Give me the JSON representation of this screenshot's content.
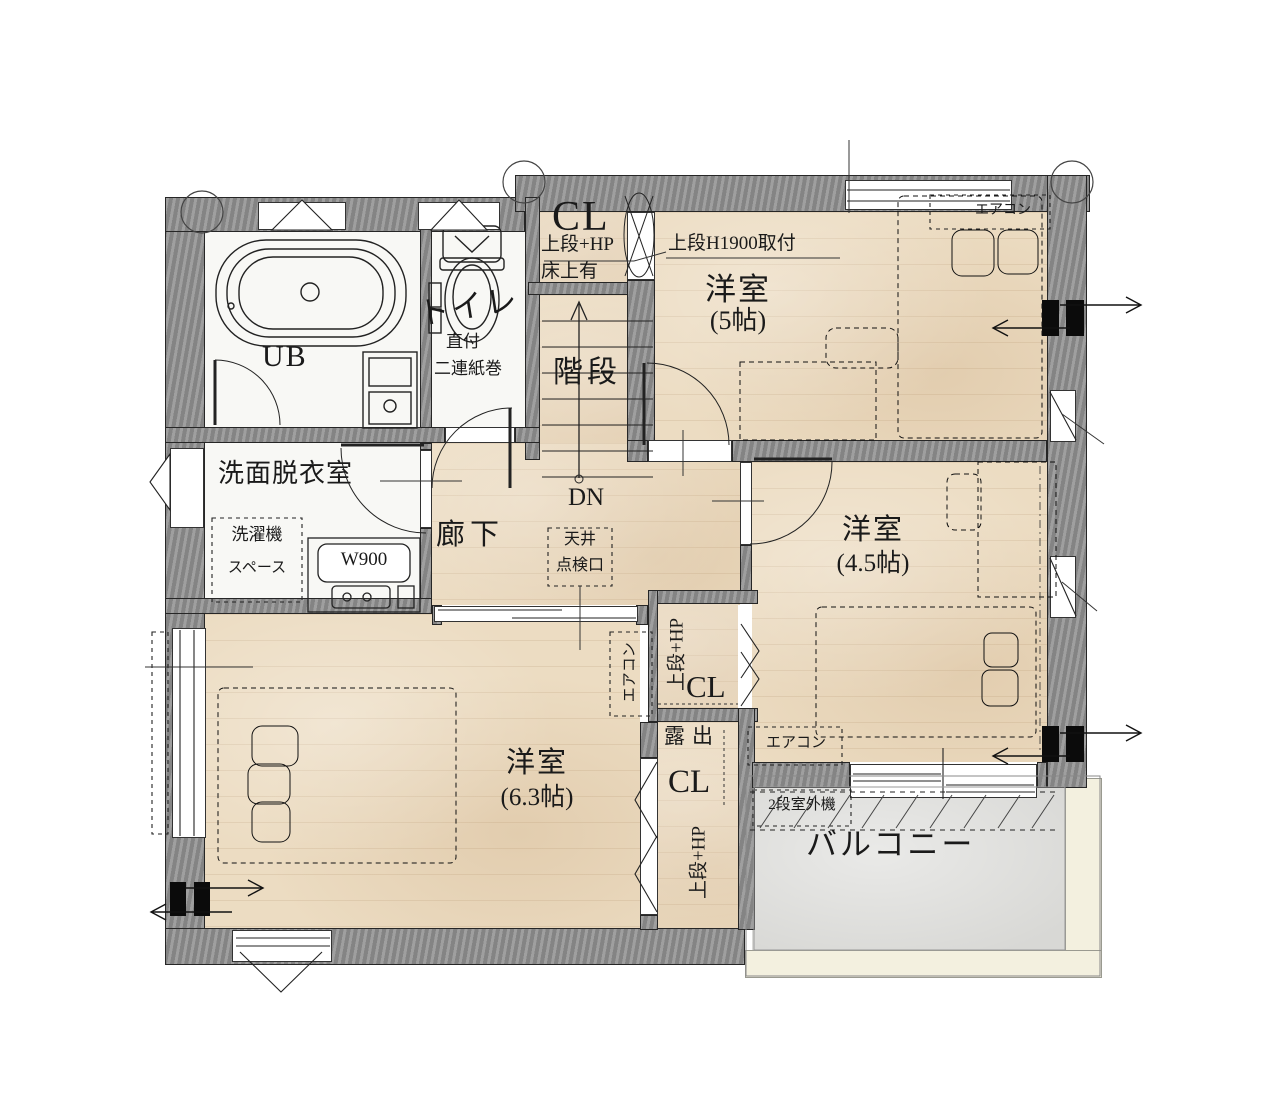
{
  "colors": {
    "floor_wood": "#ecdcc2",
    "floor_service": "#f8f8f5",
    "floor_balcony": "#d8d8d5",
    "wall": "#8f8f8f",
    "line": "#222222"
  },
  "labels": {
    "ub": "UB",
    "toilet": {
      "title": "トイレ",
      "note1": "直付",
      "note2": "二連紙巻"
    },
    "cl_top": {
      "title": "CL",
      "note1": "上段+HP",
      "note2": "床上有"
    },
    "stairs": {
      "title": "階段",
      "direction": "DN"
    },
    "room5": {
      "title": "洋室",
      "size": "(5帖)",
      "shelf_note": "上段H1900取付",
      "aircon": "エアコン"
    },
    "washroom": {
      "title": "洗面脱衣室",
      "washer_line1": "洗濯機",
      "washer_line2": "スペース",
      "vanity": "W900"
    },
    "hallway": {
      "title": "廊下",
      "hatch_line1": "天井",
      "hatch_line2": "点検口"
    },
    "room45": {
      "title": "洋室",
      "size": "(4.5帖)",
      "aircon": "エアコン"
    },
    "cl_mid": {
      "title": "CL",
      "note": "上段+HP",
      "pipe_note": "露出"
    },
    "cl_bottom": {
      "title": "CL",
      "note": "上段+HP"
    },
    "room63": {
      "title": "洋室",
      "size": "(6.3帖)",
      "aircon": "エアコン"
    },
    "balcony": {
      "title": "バルコニー",
      "outdoor_unit": "2段室外機"
    }
  }
}
